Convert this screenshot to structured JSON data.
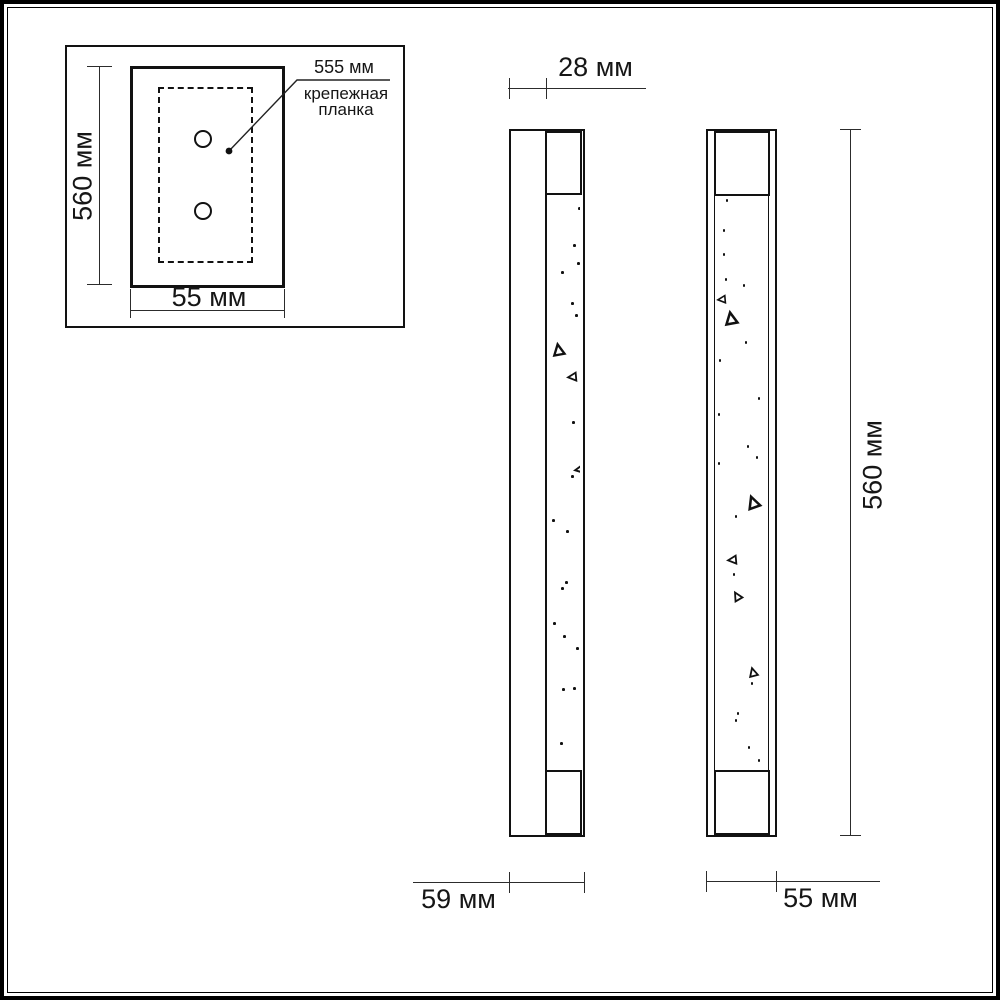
{
  "colors": {
    "line": "#121212",
    "dim": "#2c2c2c",
    "background": "#ffffff"
  },
  "inset": {
    "height_label": "560 мм",
    "width_label": "55 мм",
    "callout_value": "555 мм",
    "callout_name_line1": "крепежная",
    "callout_name_line2": "планка"
  },
  "side_view": {
    "top_dim_label": "28 мм",
    "bottom_dim_label": "59 мм",
    "sparkles": [
      {
        "k": "dot",
        "x": 30,
        "y": 12
      },
      {
        "k": "dot",
        "x": 25,
        "y": 49
      },
      {
        "k": "dot",
        "x": 29,
        "y": 67
      },
      {
        "k": "dot",
        "x": 13,
        "y": 76
      },
      {
        "k": "dot",
        "x": 23,
        "y": 107
      },
      {
        "k": "dot",
        "x": 27,
        "y": 119
      },
      {
        "k": "tri",
        "x": 4,
        "y": 148,
        "s": 13,
        "r": -10
      },
      {
        "k": "tri",
        "x": 19,
        "y": 177,
        "s": 10,
        "r": -95
      },
      {
        "k": "dot",
        "x": 24,
        "y": 226
      },
      {
        "k": "tri",
        "x": 26,
        "y": 269,
        "s": 11,
        "r": -100
      },
      {
        "k": "dot",
        "x": 23,
        "y": 280
      },
      {
        "k": "dot",
        "x": 4,
        "y": 324
      },
      {
        "k": "dot",
        "x": 18,
        "y": 335
      },
      {
        "k": "dot",
        "x": 17,
        "y": 386
      },
      {
        "k": "dot",
        "x": 13,
        "y": 392
      },
      {
        "k": "dot",
        "x": 5,
        "y": 427
      },
      {
        "k": "dot",
        "x": 15,
        "y": 440
      },
      {
        "k": "dot",
        "x": 28,
        "y": 452
      },
      {
        "k": "dot",
        "x": 25,
        "y": 492
      },
      {
        "k": "dot",
        "x": 14,
        "y": 493
      },
      {
        "k": "dot",
        "x": 12,
        "y": 547
      }
    ]
  },
  "front_view": {
    "height_dim_label": "560 мм",
    "bottom_dim_label": "55 мм",
    "sparkles": [
      {
        "k": "dot",
        "x": 10,
        "y": 4
      },
      {
        "k": "dot",
        "x": 7,
        "y": 34
      },
      {
        "k": "dot",
        "x": 7,
        "y": 58
      },
      {
        "k": "dot",
        "x": 9,
        "y": 83
      },
      {
        "k": "dot",
        "x": 27,
        "y": 89
      },
      {
        "k": "tri",
        "x": 1,
        "y": 100,
        "s": 9,
        "r": -95
      },
      {
        "k": "tri",
        "x": 8,
        "y": 116,
        "s": 14,
        "r": -10
      },
      {
        "k": "dot",
        "x": 29,
        "y": 146
      },
      {
        "k": "dot",
        "x": 3,
        "y": 164
      },
      {
        "k": "dot",
        "x": 42,
        "y": 202
      },
      {
        "k": "dot",
        "x": 2,
        "y": 218
      },
      {
        "k": "dot",
        "x": 31,
        "y": 250
      },
      {
        "k": "dot",
        "x": 40,
        "y": 261
      },
      {
        "k": "dot",
        "x": 2,
        "y": 267
      },
      {
        "k": "tri",
        "x": 30,
        "y": 300,
        "s": 14,
        "r": -20
      },
      {
        "k": "dot",
        "x": 19,
        "y": 320
      },
      {
        "k": "tri",
        "x": 11,
        "y": 360,
        "s": 10,
        "r": -95
      },
      {
        "k": "dot",
        "x": 17,
        "y": 378
      },
      {
        "k": "tri",
        "x": 16,
        "y": 396,
        "s": 10,
        "r": -30
      },
      {
        "k": "tri",
        "x": 32,
        "y": 472,
        "s": 10,
        "r": -15
      },
      {
        "k": "dot",
        "x": 35,
        "y": 487
      },
      {
        "k": "dot",
        "x": 21,
        "y": 517
      },
      {
        "k": "dot",
        "x": 19,
        "y": 524
      },
      {
        "k": "dot",
        "x": 32,
        "y": 551
      },
      {
        "k": "dot",
        "x": 42,
        "y": 564
      }
    ]
  }
}
